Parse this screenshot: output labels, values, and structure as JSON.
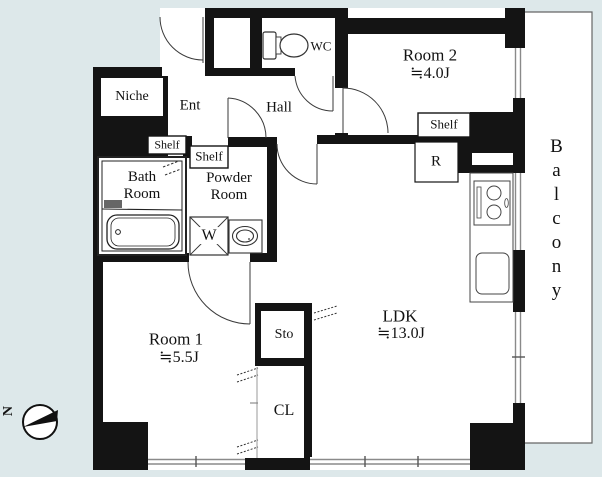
{
  "plan": {
    "type": "apartment-floor-plan",
    "rooms": {
      "room1": {
        "name": "Room 1",
        "size": "≒5.5J"
      },
      "room2": {
        "name": "Room 2",
        "size": "≒4.0J"
      },
      "ldk": {
        "name": "LDK",
        "size": "≒13.0J"
      },
      "bath": {
        "line1": "Bath",
        "line2": "Room"
      },
      "powder": {
        "line1": "Powder",
        "line2": "Room"
      }
    },
    "labels": {
      "niche": "Niche",
      "ent": "Ent",
      "hall": "Hall",
      "wc": "WC",
      "shelf": "Shelf",
      "refrigerator": "R",
      "washer": "W",
      "storage": "Sto",
      "closet": "CL",
      "balcony": "Balcony",
      "north": "N"
    },
    "colors": {
      "background": "#dde8ea",
      "wall": "#141414",
      "floor": "#ffffff",
      "window_line": "#8a8a8a",
      "balcony_outline": "#666666"
    }
  }
}
